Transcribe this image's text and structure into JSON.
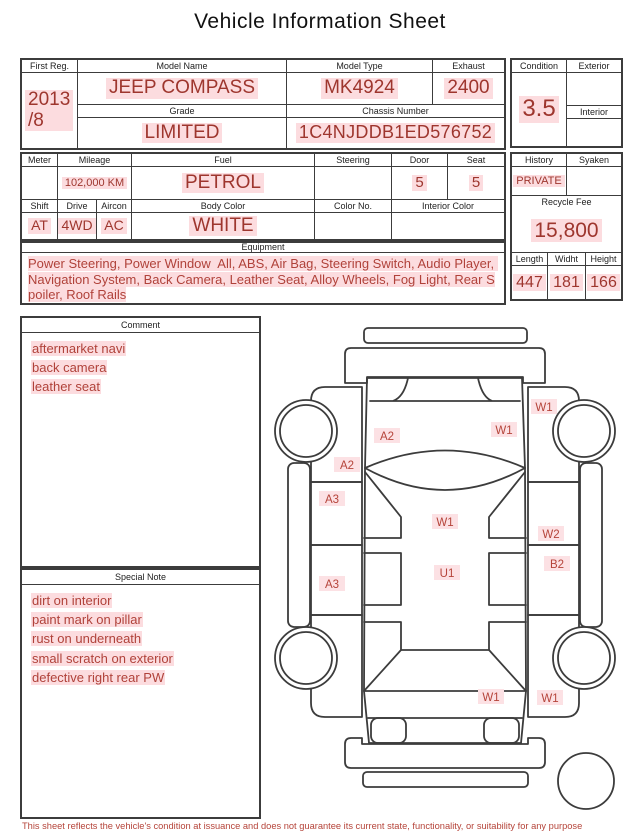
{
  "title": "Vehicle Information Sheet",
  "colors": {
    "value_red": "#9e362e",
    "note_red": "#b0423a",
    "highlight_pink": "#fcdcdf",
    "border": "#3c3c3c"
  },
  "vehicle": {
    "first_reg_label": "First Reg.",
    "first_reg_value": "2013\n/8",
    "model_name_label": "Model Name",
    "model_name_value": "JEEP COMPASS",
    "model_type_label": "Model Type",
    "model_type_value": "MK4924",
    "exhaust_label": "Exhaust",
    "exhaust_value": "2400",
    "grade_label": "Grade",
    "grade_value": "LIMITED",
    "chassis_label": "Chassis Number",
    "chassis_value": "1C4NJDDB1ED576752"
  },
  "condition": {
    "label": "Condition",
    "score": "3.5",
    "exterior_label": "Exterior",
    "interior_label": "Interior"
  },
  "specs": {
    "meter_label": "Meter",
    "mileage_label": "Mileage",
    "mileage_value": "102,000 KM",
    "fuel_label": "Fuel",
    "fuel_value": "PETROL",
    "steering_label": "Steering",
    "door_label": "Door",
    "door_value": "5",
    "seat_label": "Seat",
    "seat_value": "5",
    "shift_label": "Shift",
    "shift_value": "AT",
    "drive_label": "Drive",
    "drive_value": "4WD",
    "aircon_label": "Aircon",
    "aircon_value": "AC",
    "body_color_label": "Body Color",
    "body_color_value": "WHITE",
    "color_no_label": "Color No.",
    "interior_color_label": "Interior Color"
  },
  "admin": {
    "history_label": "History",
    "history_value": "PRIVATE",
    "syaken_label": "Syaken",
    "recycle_fee_label": "Recycle Fee",
    "recycle_fee_value": "15,800",
    "length_label": "Length",
    "length_value": "447",
    "width_label": "Widht",
    "width_value": "181",
    "height_label": "Height",
    "height_value": "166"
  },
  "equipment": {
    "label": "Equipment",
    "text": "Power Steering, Power Window  All, ABS, Air Bag, Steering Switch, Audio Player, Navigation System, Back Camera, Leather Seat, Alloy Wheels, Fog Light, Rear Spoiler, Roof Rails"
  },
  "comment": {
    "label": "Comment",
    "lines": [
      "aftermarket navi",
      "back camera",
      "leather seat"
    ]
  },
  "special_note": {
    "label": "Special Note",
    "lines": [
      "dirt on interior",
      "paint mark on pillar",
      "rust on underneath",
      "small scratch on exterior",
      "defective right rear PW"
    ]
  },
  "diagram": {
    "marks": [
      {
        "code": "W1",
        "location": "right-front-fender"
      },
      {
        "code": "W1",
        "location": "hood-right"
      },
      {
        "code": "A2",
        "location": "hood-left"
      },
      {
        "code": "A2",
        "location": "left-a-pillar"
      },
      {
        "code": "A3",
        "location": "left-front-door"
      },
      {
        "code": "W1",
        "location": "roof-front"
      },
      {
        "code": "W2",
        "location": "right-front-door"
      },
      {
        "code": "B2",
        "location": "right-rear-door"
      },
      {
        "code": "A3",
        "location": "left-rear-door"
      },
      {
        "code": "U1",
        "location": "roof-center"
      },
      {
        "code": "W1",
        "location": "rear-glass"
      },
      {
        "code": "W1",
        "location": "right-rear-quarter"
      }
    ]
  },
  "footer": {
    "disclaimer": "This sheet reflects the vehicle's condition at issuance and does not guarantee its current state, functionality, or suitability for any purpose"
  }
}
